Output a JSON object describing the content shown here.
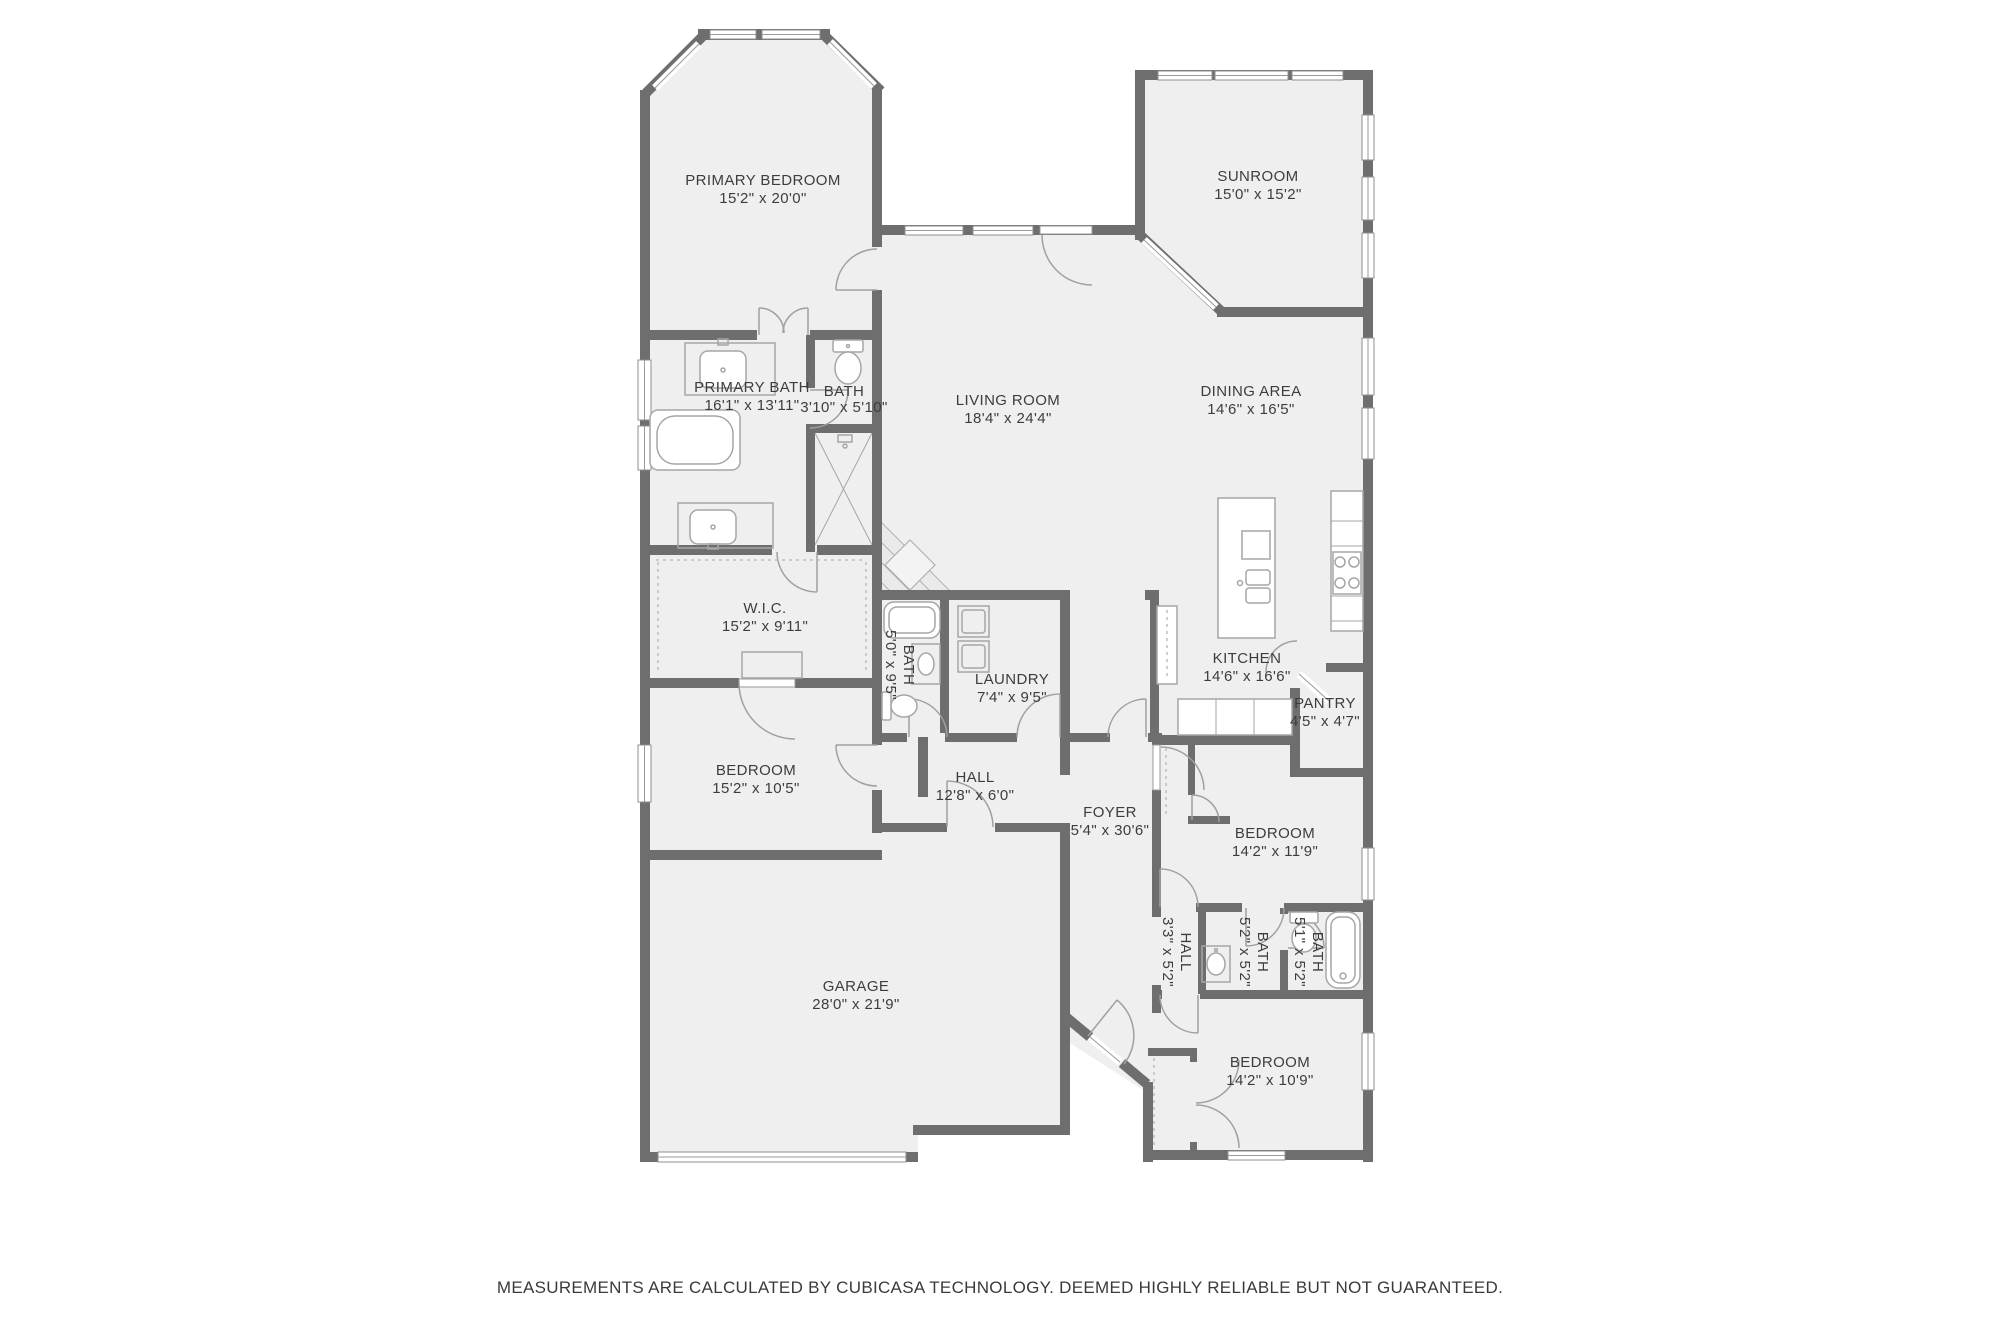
{
  "plan": {
    "rooms": [
      {
        "id": "primary-bedroom",
        "name": "PRIMARY BEDROOM",
        "dims": "15'2\" x 20'0\""
      },
      {
        "id": "sunroom",
        "name": "SUNROOM",
        "dims": "15'0\" x 15'2\""
      },
      {
        "id": "primary-bath",
        "name": "PRIMARY BATH",
        "dims": "16'1\" x 13'11\""
      },
      {
        "id": "bath-small",
        "name": "BATH",
        "dims": "3'10\" x 5'10\""
      },
      {
        "id": "living-room",
        "name": "LIVING ROOM",
        "dims": "18'4\" x 24'4\""
      },
      {
        "id": "dining-area",
        "name": "DINING AREA",
        "dims": "14'6\" x 16'5\""
      },
      {
        "id": "wic",
        "name": "W.I.C.",
        "dims": "15'2\" x 9'11\""
      },
      {
        "id": "bath-hall",
        "name": "BATH",
        "dims": "5'0\" x 9'5\""
      },
      {
        "id": "laundry",
        "name": "LAUNDRY",
        "dims": "7'4\" x 9'5\""
      },
      {
        "id": "kitchen",
        "name": "KITCHEN",
        "dims": "14'6\" x 16'6\""
      },
      {
        "id": "pantry",
        "name": "PANTRY",
        "dims": "4'5\" x 4'7\""
      },
      {
        "id": "bedroom-2",
        "name": "BEDROOM",
        "dims": "15'2\" x 10'5\""
      },
      {
        "id": "hall",
        "name": "HALL",
        "dims": "12'8\" x 6'0\""
      },
      {
        "id": "foyer",
        "name": "FOYER",
        "dims": "5'4\" x 30'6\""
      },
      {
        "id": "bedroom-3",
        "name": "BEDROOM",
        "dims": "14'2\" x 11'9\""
      },
      {
        "id": "hall-small",
        "name": "HALL",
        "dims": "3'3\" x 5'2\""
      },
      {
        "id": "bath-2",
        "name": "BATH",
        "dims": "5'2\" x 5'2\""
      },
      {
        "id": "bath-3",
        "name": "BATH",
        "dims": "5'1\" x 5'2\""
      },
      {
        "id": "garage",
        "name": "GARAGE",
        "dims": "28'0\" x 21'9\""
      },
      {
        "id": "bedroom-4",
        "name": "BEDROOM",
        "dims": "14'2\" x 10'9\""
      }
    ],
    "footer": "MEASUREMENTS ARE CALCULATED BY CUBICASA TECHNOLOGY. DEEMED HIGHLY RELIABLE BUT NOT GUARANTEED.",
    "colors": {
      "wall": "#6e6e6e",
      "floor": "#efefef",
      "background": "#ffffff",
      "text": "#3d3d3d"
    }
  }
}
